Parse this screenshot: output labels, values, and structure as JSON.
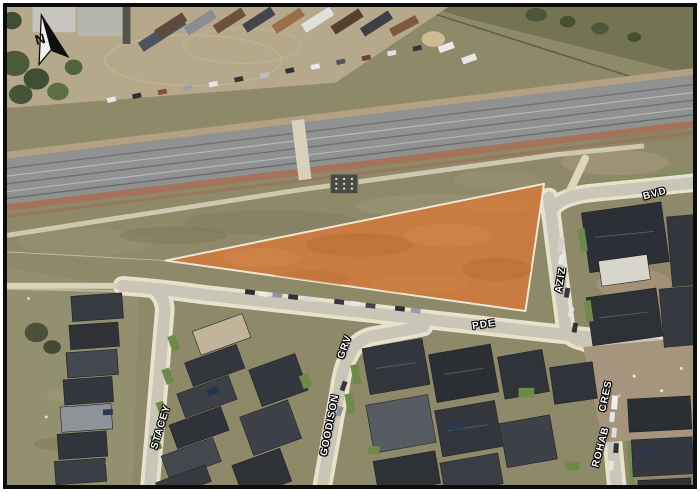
{
  "map": {
    "type": "aerial-site-map",
    "north_label": "N",
    "street_labels": [
      {
        "label": "BVD",
        "x": 661,
        "y": 192,
        "rotation": -15
      },
      {
        "label": "AZIZ",
        "x": 565,
        "y": 281,
        "rotation": -81
      },
      {
        "label": "PDE",
        "x": 487,
        "y": 327,
        "rotation": -8
      },
      {
        "label": "GRV",
        "x": 345,
        "y": 350,
        "rotation": -70
      },
      {
        "label": "GOODISON",
        "x": 330,
        "y": 430,
        "rotation": -79
      },
      {
        "label": "STACEY",
        "x": 157,
        "y": 432,
        "rotation": -73
      },
      {
        "label": "CRES",
        "x": 611,
        "y": 400,
        "rotation": -78
      },
      {
        "label": "ROHAB",
        "x": 606,
        "y": 453,
        "rotation": -75
      }
    ],
    "parcel": {
      "fill": "#C87C41",
      "outline": "#F0E9D6"
    },
    "colors": {
      "frame": "#0D0D0D",
      "label_text": "#FFFFFF",
      "label_halo": "#000000",
      "railway_gray": "#909191",
      "ballast_red": "#A4735A",
      "scrub": "#8E8969",
      "truck_yard_dirt": "#B6A88B",
      "road_asphalt": "#C9C6B8",
      "sidewalk": "#E8E1CB",
      "roof_dark": "#33373D",
      "lawn_green": "#6D8A49",
      "construction_dirt": "#A6957D"
    }
  }
}
